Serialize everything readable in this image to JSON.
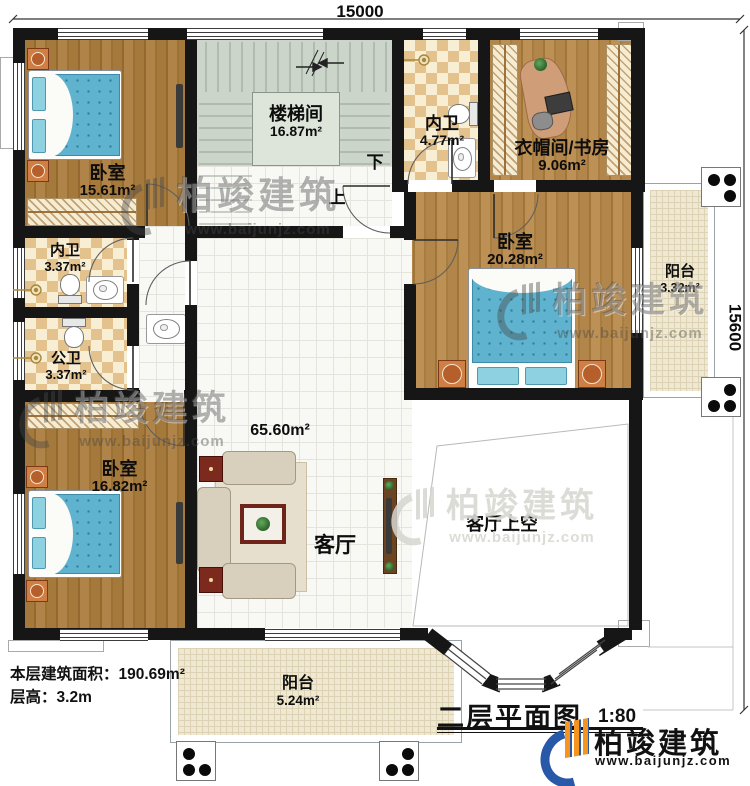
{
  "dimensions": {
    "top": "15000",
    "right": "15600"
  },
  "rooms": [
    {
      "id": "bedroom-top-left",
      "name": "卧室",
      "area": "15.61m²"
    },
    {
      "id": "stairwell",
      "name": "楼梯间",
      "area": "16.87m²"
    },
    {
      "id": "bath-top",
      "name": "内卫",
      "area": "4.77m²"
    },
    {
      "id": "cloakroom-study",
      "name": "衣帽间/书房",
      "area": "9.06m²"
    },
    {
      "id": "bedroom-right",
      "name": "卧室",
      "area": "20.28m²"
    },
    {
      "id": "balcony-right",
      "name": "阳台",
      "area": "3.32m²"
    },
    {
      "id": "bath-left-upper",
      "name": "内卫",
      "area": "3.37m²"
    },
    {
      "id": "bath-left-lower",
      "name": "公卫",
      "area": "3.37m²"
    },
    {
      "id": "bedroom-bottom-left",
      "name": "卧室",
      "area": "16.82m²"
    },
    {
      "id": "living-room",
      "name": "客厅",
      "area": "65.60m²"
    },
    {
      "id": "living-void",
      "name": "客厅上空"
    },
    {
      "id": "balcony-bottom",
      "name": "阳台",
      "area": "5.24m²"
    }
  ],
  "stairs": {
    "up": "上",
    "down": "下"
  },
  "info": {
    "area_label": "本层建筑面积：",
    "area_value": "190.69m²",
    "height_label": "层高：",
    "height_value": "3.2m"
  },
  "title": {
    "text": "二层平面图",
    "scale": "1:80"
  },
  "brand": {
    "name": "柏竣建筑",
    "url": "www.baijunjz.com"
  },
  "watermark": {
    "name": "柏竣建筑",
    "url": "www.baijunjz.com"
  },
  "palette": {
    "wall": "#161616",
    "wood": "#a5783c",
    "checker_tan": "#e3c28d",
    "stair_sage": "#cbd5ca",
    "bed_blue": "#5fb3cf",
    "brand_blue": "#2858a8",
    "brand_orange": "#f7941d"
  }
}
